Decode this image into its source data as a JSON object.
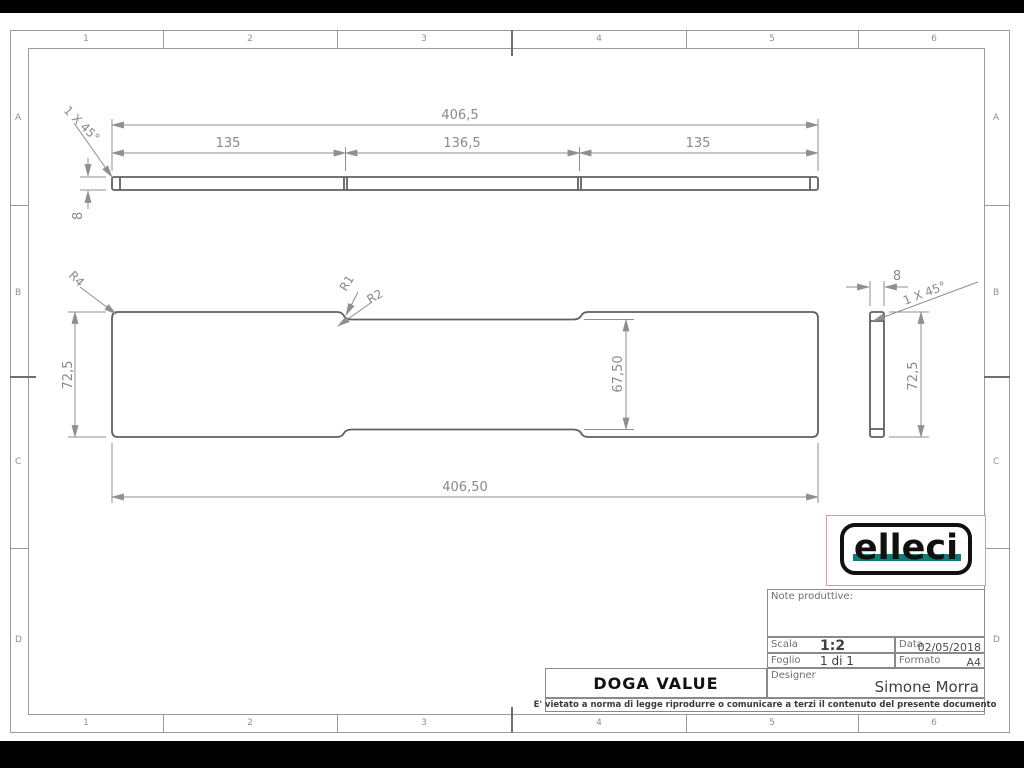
{
  "grid": {
    "columns": [
      "1",
      "2",
      "3",
      "4",
      "5",
      "6"
    ],
    "rows": [
      "A",
      "B",
      "C",
      "D"
    ]
  },
  "views": {
    "top": {
      "overall": "406,5",
      "segments": [
        "135",
        "136,5",
        "135"
      ],
      "thickness": "8",
      "chamfer": "1 X 45°"
    },
    "front": {
      "height": "72,5",
      "inner_height": "67,50",
      "overall": "406,50",
      "radius_labels": [
        "R4",
        "R1",
        "R2"
      ]
    },
    "side": {
      "width": "8",
      "chamfer": "1 X 45°",
      "height": "72,5"
    }
  },
  "title_block": {
    "logo_text": "elleci",
    "notes_label": "Note produttive:",
    "scala_label": "Scala",
    "scala_value": "1:2",
    "data_label": "Data",
    "data_value": "02/05/2018",
    "foglio_label": "Foglio",
    "foglio_value": "1 di 1",
    "formato_label": "Formato",
    "formato_value": "A4",
    "designer_label": "Designer",
    "designer_value": "Simone Morra",
    "part_title": "DOGA VALUE",
    "legal_note": "E' vietato a norma di legge riprodurre o comunicare a terzi il contenuto del presente documento"
  },
  "colors": {
    "part_line": "#606060",
    "dim_line": "#8f8f8f",
    "dim_text": "#8a8a8a",
    "frame_line": "#9a9a9a",
    "logo_teal": "#0e7d79",
    "logo_box_border": "#d89a9a"
  }
}
